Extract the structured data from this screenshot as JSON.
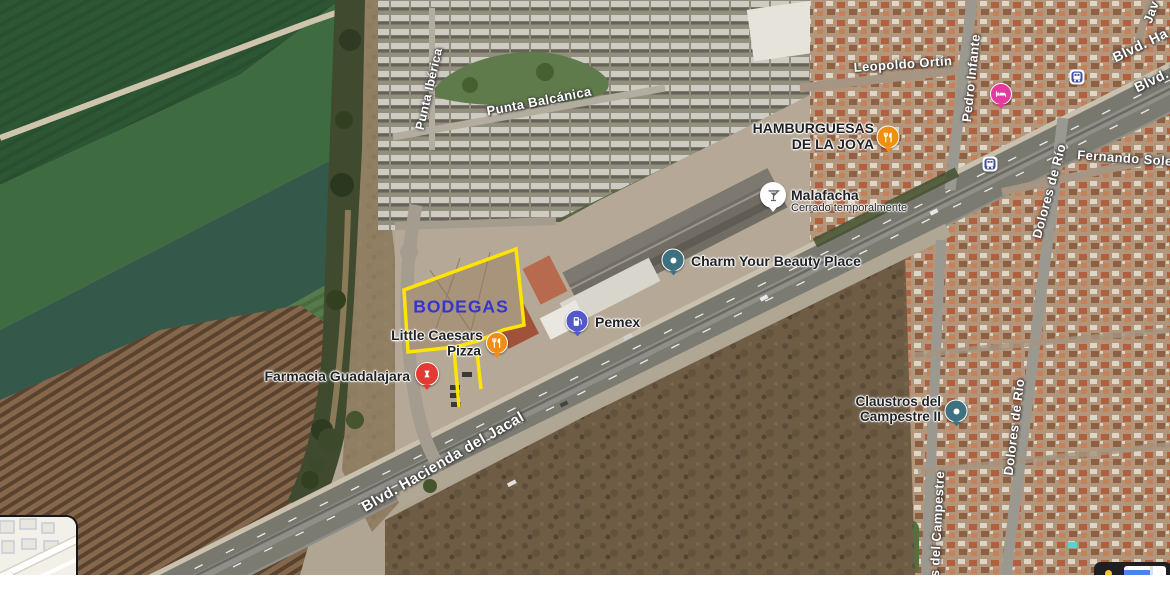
{
  "streets": {
    "punta_iberica": "Punta Ibérica",
    "punta_balcanica": "Punta Balcánica",
    "leopoldo_ortin": "Leopoldo Ortín",
    "pedro_infante": "Pedro Infante",
    "fernando_sole": "Fernando Sole",
    "dolores_de_rio_1": "Dolores de Río",
    "dolores_de_rio_2": "Dolores de Río",
    "campestre": "s del Campestre",
    "blvd_jacal": "Blvd. Hacienda del Jacal",
    "blvd_ha": "Blvd. Ha",
    "blvd_h": "Blvd. H",
    "jav": "Jav"
  },
  "pois": {
    "hamburguesas": {
      "line1": "HAMBURGUESAS",
      "line2": "DE LA JOYA",
      "icon": "restaurant-icon",
      "color": "#ef8e13"
    },
    "malafacha": {
      "name": "Malafacha",
      "status": "Cerrado temporalmente",
      "icon": "cocktail-icon",
      "color": "#ffffff"
    },
    "charm": {
      "name": "Charm Your Beauty Place",
      "icon": "generic-place-icon",
      "color": "#3e7180"
    },
    "pemex": {
      "name": "Pemex",
      "icon": "gas-station-icon",
      "color": "#5359c9"
    },
    "little_caesars": {
      "line1": "Little Caesars",
      "line2": "Pizza",
      "icon": "restaurant-icon",
      "color": "#ef8e13"
    },
    "farmacia": {
      "name": "Farmacia Guadalajara",
      "icon": "pharmacy-icon",
      "color": "#e23b33"
    },
    "claustros": {
      "line1": "Claustros del",
      "line2": "Campestre II",
      "icon": "generic-place-icon",
      "color": "#3e7180"
    },
    "hotel": {
      "icon": "hotel-icon",
      "color": "#e5399d"
    },
    "transit": {
      "icon": "bus-icon",
      "color": "#414f9c"
    }
  },
  "property_overlay": {
    "label": "BODEGAS",
    "label_color": "#3335cf",
    "outline_color": "#ffe400"
  }
}
